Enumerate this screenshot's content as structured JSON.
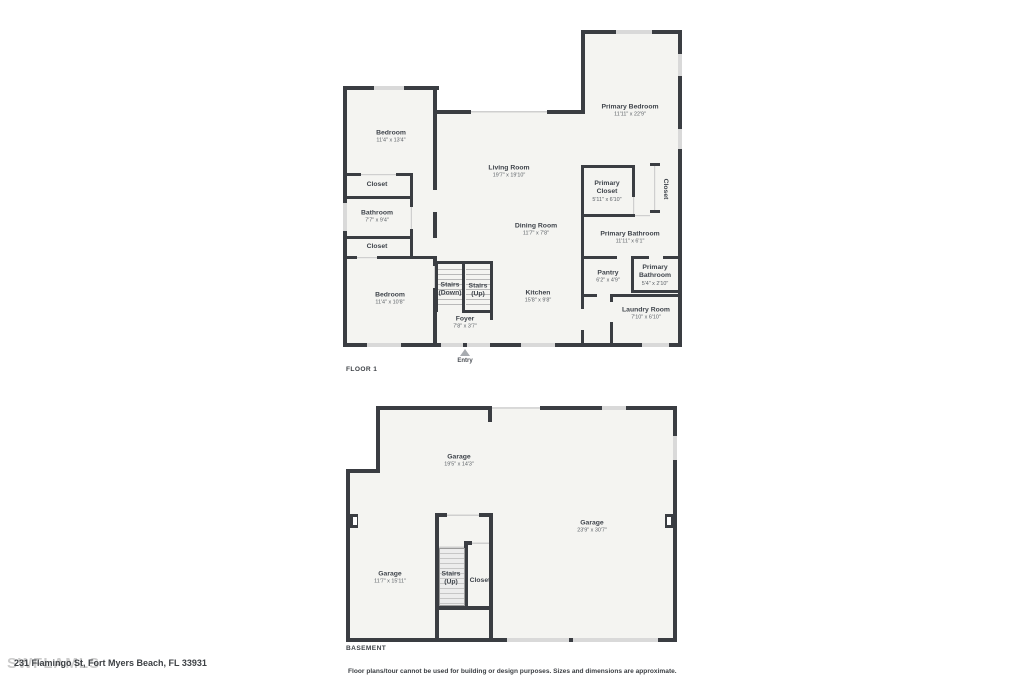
{
  "page": {
    "address": "231 Flamingo St, Fort Myers Beach, FL 33931",
    "watermark": "SWFLAMLS",
    "disclaimer": "Floor plans/tour cannot be used for building or design purposes. Sizes and dimensions are approximate."
  },
  "colors": {
    "wall": "#3a3d42",
    "floor_fill": "#f4f4f1",
    "window": "#d9d9d9",
    "opening_line": "#cfcfcf",
    "label_text": "#3f444b",
    "dims_text": "#5c6167",
    "watermark_text": "#cccccc"
  },
  "floor1": {
    "label": "FLOOR 1",
    "entry_label": "Entry",
    "rooms": [
      {
        "name": "Bedroom",
        "dims": "11'4\" x 13'4\""
      },
      {
        "name": "Closet",
        "dims": ""
      },
      {
        "name": "Bathroom",
        "dims": "7'7\" x 9'4\""
      },
      {
        "name": "Closet",
        "dims": ""
      },
      {
        "name": "Bedroom",
        "dims": "11'4\" x 10'8\""
      },
      {
        "name": "Living Room",
        "dims": "19'7\" x 19'10\""
      },
      {
        "name": "Dining Room",
        "dims": "11'7\" x 7'8\""
      },
      {
        "name": "Kitchen",
        "dims": "15'8\" x 9'8\""
      },
      {
        "name": "Stairs (Down)",
        "dims": ""
      },
      {
        "name": "Stairs (Up)",
        "dims": ""
      },
      {
        "name": "Foyer",
        "dims": "7'8\" x 3'7\""
      },
      {
        "name": "Primary Bedroom",
        "dims": "11'11\" x 22'9\""
      },
      {
        "name": "Primary Closet",
        "dims": "5'11\" x 6'10\""
      },
      {
        "name": "Closet",
        "dims": ""
      },
      {
        "name": "Primary Bathroom",
        "dims": "11'11\" x 6'1\""
      },
      {
        "name": "Pantry",
        "dims": "6'2\" x 4'9\""
      },
      {
        "name": "Primary Bathroom",
        "dims": "5'4\" x 2'10\""
      },
      {
        "name": "Laundry Room",
        "dims": "7'10\" x 6'10\""
      }
    ]
  },
  "basement": {
    "label": "BASEMENT",
    "rooms": [
      {
        "name": "Garage",
        "dims": "19'5\" x 14'3\""
      },
      {
        "name": "Garage",
        "dims": "23'9\" x 30'7\""
      },
      {
        "name": "Garage",
        "dims": "11'7\" x 15'11\""
      },
      {
        "name": "Stairs (Up)",
        "dims": ""
      },
      {
        "name": "Closet",
        "dims": ""
      }
    ]
  }
}
